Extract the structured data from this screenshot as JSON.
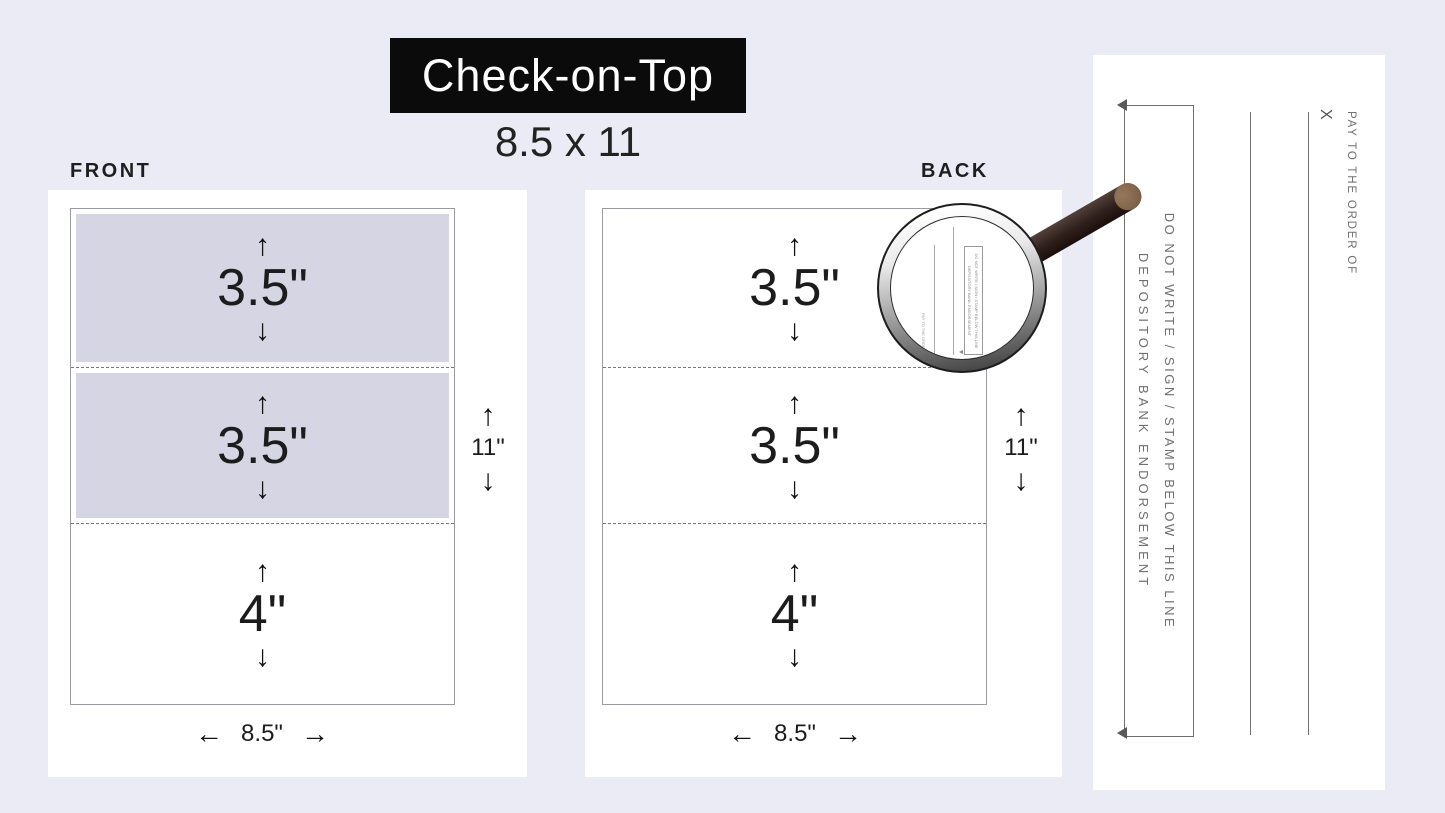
{
  "title": {
    "label": "Check-on-Top",
    "size": "8.5 x 11"
  },
  "front": {
    "label": "FRONT",
    "page": {
      "sections": [
        {
          "label": "3.5\"",
          "shaded": true
        },
        {
          "label": "3.5\"",
          "shaded": true
        },
        {
          "label": "4\"",
          "shaded": false
        }
      ]
    },
    "height_label": "11\"",
    "width_label": "8.5\""
  },
  "back": {
    "label": "BACK",
    "page": {
      "sections": [
        {
          "label": "3.5\"",
          "shaded": false
        },
        {
          "label": "3.5\"",
          "shaded": false
        },
        {
          "label": "4\"",
          "shaded": false
        }
      ]
    },
    "height_label": "11\"",
    "width_label": "8.5\""
  },
  "check_back": {
    "endorsement_box_line1": "DO NOT WRITE / SIGN / STAMP BELOW THIS LINE",
    "endorsement_box_line2": "DEPOSITORY BANK ENDORSEMENT",
    "signature_mark": "X",
    "pay_to_label": "PAY TO THE ORDER OF"
  },
  "icons": {
    "up_arrow": "↑",
    "down_arrow": "↓",
    "left_arrow": "←",
    "right_arrow": "→"
  },
  "colors": {
    "background": "#ebebf5",
    "card": "#ffffff",
    "shaded_section": "#d6d5e4",
    "title_bg": "#0b0b0b",
    "title_text": "#ffffff",
    "line_gray": "#6f6f6f",
    "text_dark": "#1e1e1e",
    "handle_brown": "#2e1f1a",
    "handle_tip": "#86694e"
  }
}
